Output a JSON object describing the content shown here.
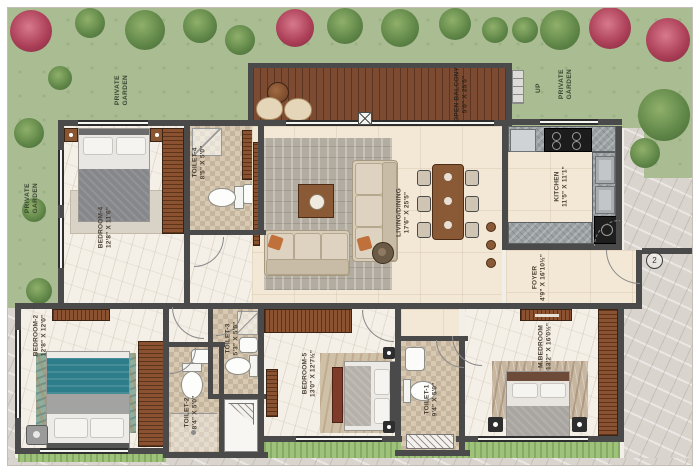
{
  "gardens": {
    "top_left": "PRIVATE GARDEN",
    "left": "PRIVATE GARDEN",
    "top_right": "PRIVATE GARDEN",
    "up_label": "UP"
  },
  "entry_marker": "2",
  "rooms": {
    "bedroom4": {
      "name": "BEDROOM-4",
      "dims": "12'8\" X 11'6\""
    },
    "toilet4": {
      "name": "TOILET-4",
      "dims": "8'5\" X 5'0\""
    },
    "living": {
      "name": "LIVING/DINING",
      "dims": "17'6\" X 25'5\""
    },
    "balcony": {
      "name": "OPEN BALCONY",
      "dims": "5'0\" X 25'5\""
    },
    "kitchen": {
      "name": "KITCHEN",
      "dims": "11'5\" X 11'1\""
    },
    "foyer": {
      "name": "FOYER",
      "dims": "4'9\" X 16'10½\""
    },
    "bedroom2": {
      "name": "BEDROOM-2",
      "dims": "12'8\" X 12'0\""
    },
    "toilet2": {
      "name": "TOILET-2",
      "dims": "8'4\" X 5'0\""
    },
    "toilet3": {
      "name": "TOILET-3",
      "dims": "5'3\" X 5'0\""
    },
    "bedroom5": {
      "name": "BEDROOM-5",
      "dims": "13'0\" X 12'7½\""
    },
    "toilet1": {
      "name": "TOILET-1",
      "dims": "9'4\" X 5'0\""
    },
    "master": {
      "name": "M.BEDROOM",
      "dims": "13'2\" X 16'0½\""
    }
  },
  "colors": {
    "garden": "#a9bc92",
    "wall": "#4a4a4a",
    "deck_wood": "#7c4b31",
    "marble": "#f4efe7",
    "living_floor": "#f3e8d5",
    "tile": "#d8c9b2",
    "accent_cushion": "#c0703a",
    "teal_bed": "#2e7d8a"
  }
}
